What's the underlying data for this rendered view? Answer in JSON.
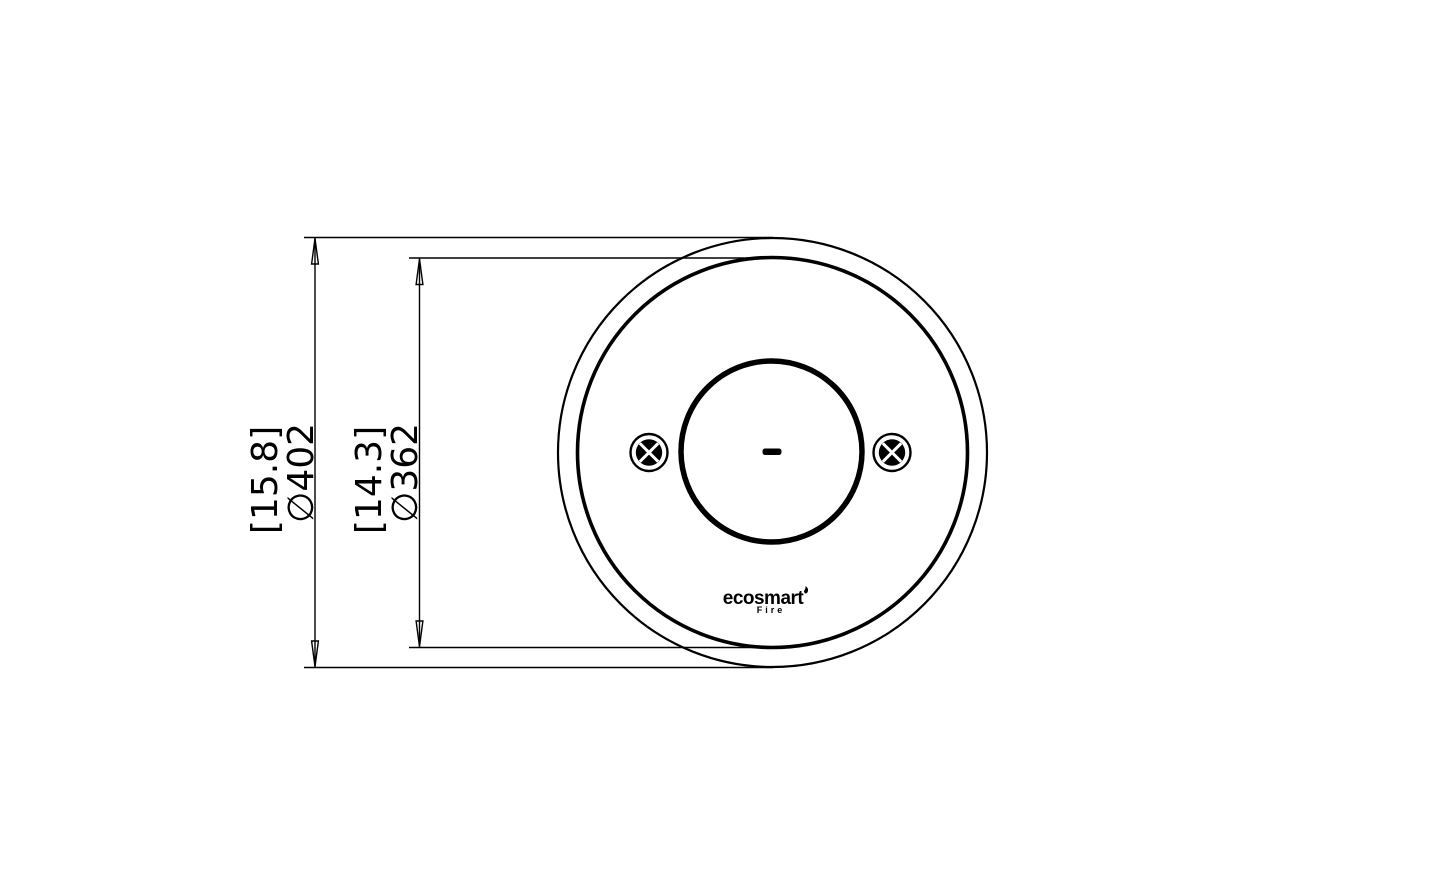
{
  "drawing": {
    "background_color": "#ffffff",
    "line_color": "#000000",
    "dimensions": [
      {
        "id": "outer-diameter",
        "imperial": "[15.8]",
        "metric": "∅402"
      },
      {
        "id": "inner-diameter",
        "imperial": "[14.3]",
        "metric": "∅362"
      }
    ],
    "logo": {
      "brand": "ecosmart",
      "sub": "Fire"
    },
    "icons": {
      "screw_left": "cross-slot-screw",
      "screw_right": "cross-slot-screw",
      "center_mark": "center-dash",
      "flame_mark": "flame"
    }
  }
}
